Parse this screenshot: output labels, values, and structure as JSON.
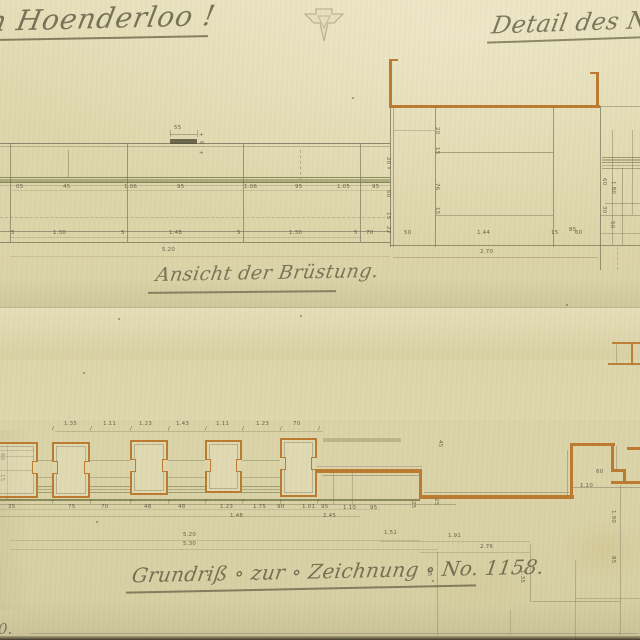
{
  "header": {
    "title_left": "n Hoenderloo !",
    "title_right": "Detail des Nord",
    "stamp_icon": "embossed-triangle-stamp"
  },
  "elevation": {
    "caption": "Ansicht der Brüstung."
  },
  "plan": {
    "caption": "Grundriß ∘ zur ∘ Zeichnung ∘ No. 1158."
  },
  "corner_note": "0.",
  "colors": {
    "p": "#76715a",
    "g": "#6f7340",
    "o": "#bd7b31",
    "d": "#55523c",
    "s": "#a39b76",
    "ink": "#6b684c",
    "paper": "#ded7ac"
  },
  "geometry": {
    "lines": [
      [
        0,
        143,
        390,
        1,
        "p",
        0.8
      ],
      [
        0,
        146,
        390,
        1,
        "p",
        0.4
      ],
      [
        0,
        177,
        390,
        1,
        "g",
        0.75
      ],
      [
        0,
        179,
        390,
        3,
        "g",
        0.45
      ],
      [
        0,
        182,
        390,
        1,
        "g",
        0.8
      ],
      [
        0,
        185,
        390,
        1,
        "p",
        0.3
      ],
      [
        0,
        217,
        390,
        1,
        "p",
        0.35,
        1
      ],
      [
        0,
        231,
        390,
        1,
        "p",
        0.65
      ],
      [
        0,
        242,
        390,
        1,
        "p",
        0.75
      ],
      [
        12,
        190,
        376,
        1,
        "p",
        0.22
      ],
      [
        10,
        237,
        352,
        1,
        "p",
        0.25
      ],
      [
        10,
        256,
        380,
        1,
        "p",
        0.2
      ],
      [
        10,
        143,
        1,
        99,
        "p",
        0.65
      ],
      [
        127,
        143,
        1,
        99,
        "p",
        0.65
      ],
      [
        243,
        143,
        1,
        99,
        "p",
        0.65
      ],
      [
        360,
        143,
        1,
        99,
        "p",
        0.65
      ],
      [
        68,
        150,
        1,
        28,
        "p",
        0.45
      ],
      [
        300,
        150,
        1,
        30,
        "p",
        0.45,
        2
      ],
      [
        170,
        139,
        27,
        5,
        "d",
        0.85
      ],
      [
        170,
        134,
        27,
        1,
        "p",
        0.5
      ],
      [
        170,
        130,
        1,
        7,
        "p",
        0.5
      ],
      [
        197,
        130,
        1,
        7,
        "p",
        0.5
      ],
      [
        389,
        59,
        9,
        2,
        "o",
        1
      ],
      [
        389,
        60,
        3,
        47,
        "o",
        1
      ],
      [
        389,
        105,
        211,
        3,
        "o",
        1
      ],
      [
        596,
        73,
        3,
        33,
        "o",
        1
      ],
      [
        590,
        72,
        9,
        2,
        "o",
        1
      ],
      [
        390,
        107,
        1,
        140,
        "p",
        0.75
      ],
      [
        393,
        107,
        1,
        140,
        "p",
        0.5
      ],
      [
        435,
        107,
        1,
        140,
        "p",
        0.65
      ],
      [
        553,
        107,
        1,
        140,
        "p",
        0.65
      ],
      [
        600,
        106,
        1,
        164,
        "p",
        0.7
      ],
      [
        435,
        152,
        118,
        1,
        "p",
        0.55
      ],
      [
        435,
        215,
        118,
        1,
        "p",
        0.45
      ],
      [
        390,
        245,
        250,
        1,
        "p",
        0.7
      ],
      [
        393,
        257,
        205,
        1,
        "p",
        0.35
      ],
      [
        393,
        130,
        42,
        1,
        "p",
        0.3
      ],
      [
        600,
        106,
        40,
        1,
        "p",
        0.45
      ],
      [
        602,
        157,
        38,
        1,
        "g",
        0.6
      ],
      [
        602,
        159,
        38,
        2,
        "g",
        0.4
      ],
      [
        602,
        162,
        38,
        1,
        "g",
        0.6
      ],
      [
        602,
        165,
        38,
        1,
        "p",
        0.4
      ],
      [
        602,
        168,
        38,
        1,
        "g",
        0.5
      ],
      [
        612,
        130,
        1,
        115,
        "p",
        0.45
      ],
      [
        622,
        168,
        1,
        77,
        "p",
        0.45
      ],
      [
        632,
        130,
        1,
        85,
        "p",
        0.4
      ],
      [
        605,
        203,
        35,
        1,
        "p",
        0.45
      ],
      [
        600,
        215,
        40,
        1,
        "p",
        0.45
      ],
      [
        600,
        233,
        40,
        1,
        "p",
        0.35
      ],
      [
        617,
        247,
        1,
        23,
        "p",
        0.3,
        2
      ],
      [
        0,
        307,
        640,
        1,
        "s",
        0.45
      ],
      [
        55,
        431,
        268,
        1,
        "p",
        0.3
      ],
      [
        0,
        450,
        34,
        1,
        "p",
        0.45
      ],
      [
        0,
        456,
        34,
        1,
        "p",
        0.45
      ],
      [
        0,
        470,
        34,
        1,
        "g",
        0.45
      ],
      [
        38,
        460,
        14,
        1,
        "p",
        0.4
      ],
      [
        90,
        460,
        40,
        1,
        "p",
        0.4
      ],
      [
        168,
        460,
        37,
        1,
        "p",
        0.4
      ],
      [
        242,
        460,
        38,
        1,
        "p",
        0.4
      ],
      [
        38,
        477,
        14,
        1,
        "p",
        0.35
      ],
      [
        90,
        477,
        40,
        1,
        "p",
        0.35
      ],
      [
        168,
        477,
        37,
        1,
        "p",
        0.35
      ],
      [
        242,
        477,
        38,
        1,
        "p",
        0.35
      ],
      [
        38,
        486,
        14,
        1,
        "g",
        0.55
      ],
      [
        38,
        489,
        14,
        1,
        "g",
        0.4
      ],
      [
        38,
        492,
        14,
        1,
        "g",
        0.55
      ],
      [
        90,
        486,
        40,
        1,
        "g",
        0.55
      ],
      [
        90,
        489,
        40,
        1,
        "g",
        0.4
      ],
      [
        90,
        492,
        40,
        1,
        "g",
        0.55
      ],
      [
        168,
        486,
        37,
        1,
        "g",
        0.55
      ],
      [
        168,
        489,
        37,
        1,
        "g",
        0.4
      ],
      [
        168,
        492,
        37,
        1,
        "g",
        0.55
      ],
      [
        242,
        486,
        38,
        1,
        "g",
        0.55
      ],
      [
        242,
        489,
        38,
        1,
        "g",
        0.4
      ],
      [
        242,
        492,
        38,
        1,
        "g",
        0.55
      ],
      [
        323,
        438,
        78,
        4,
        "g",
        0.3
      ],
      [
        317,
        469,
        105,
        3.5,
        "o",
        1
      ],
      [
        317,
        466,
        105,
        1,
        "p",
        0.35
      ],
      [
        322,
        475,
        98,
        1,
        "p",
        0.45
      ],
      [
        419,
        470,
        3,
        28,
        "o",
        1
      ],
      [
        419,
        495,
        155,
        3.5,
        "o",
        1
      ],
      [
        424,
        492,
        145,
        1,
        "p",
        0.45
      ],
      [
        570,
        446,
        3,
        52,
        "o",
        1
      ],
      [
        567,
        450,
        1,
        45,
        "p",
        0.4
      ],
      [
        570,
        443,
        45,
        2.5,
        "o",
        1
      ],
      [
        611,
        443,
        2.5,
        29,
        "o",
        1
      ],
      [
        611,
        469,
        15,
        2.5,
        "o",
        1
      ],
      [
        623,
        469,
        2.5,
        14,
        "o",
        1
      ],
      [
        611,
        481,
        29,
        2.5,
        "o",
        1
      ],
      [
        627,
        447,
        13,
        2.5,
        "o",
        1
      ],
      [
        572,
        487,
        68,
        1,
        "p",
        0.45
      ],
      [
        616,
        446,
        1,
        24,
        "p",
        0.35
      ],
      [
        612,
        342,
        28,
        2,
        "o",
        0.95
      ],
      [
        608,
        363,
        32,
        2,
        "o",
        0.95
      ],
      [
        631,
        342,
        2,
        23,
        "o",
        0.95
      ],
      [
        616,
        344,
        1,
        20,
        "p",
        0.35
      ],
      [
        0,
        499,
        420,
        1.5,
        "g",
        0.75
      ],
      [
        0,
        504,
        456,
        1,
        "p",
        0.45
      ],
      [
        0,
        509,
        380,
        1,
        "p",
        0.22
      ],
      [
        0,
        516,
        360,
        1,
        "p",
        0.3
      ],
      [
        10,
        540,
        410,
        1,
        "p",
        0.25
      ],
      [
        10,
        549,
        428,
        1,
        "p",
        0.25
      ],
      [
        380,
        541,
        150,
        1,
        "p",
        0.28
      ],
      [
        420,
        552,
        110,
        1,
        "p",
        0.28
      ],
      [
        437,
        552,
        1,
        83,
        "p",
        0.4
      ],
      [
        530,
        544,
        1,
        58,
        "p",
        0.4
      ],
      [
        532,
        601,
        88,
        1,
        "p",
        0.4
      ],
      [
        575,
        560,
        1,
        80,
        "p",
        0.35
      ],
      [
        575,
        598,
        65,
        1,
        "p",
        0.35
      ],
      [
        620,
        485,
        1,
        150,
        "p",
        0.4
      ],
      [
        30,
        633,
        608,
        1,
        "p",
        0.35
      ],
      [
        510,
        610,
        1,
        25,
        "p",
        0.3
      ],
      [
        7,
        445,
        1,
        55,
        "p",
        0.35
      ],
      [
        333,
        473,
        1,
        32,
        "p",
        0.4
      ],
      [
        352,
        473,
        1,
        32,
        "p",
        0.35
      ]
    ],
    "labels": [
      [
        16,
        185,
        "05"
      ],
      [
        63,
        185,
        "45"
      ],
      [
        124,
        185,
        "1.06"
      ],
      [
        177,
        185,
        "95"
      ],
      [
        244,
        185,
        "1.06"
      ],
      [
        295,
        185,
        "95"
      ],
      [
        337,
        185,
        "1.05"
      ],
      [
        372,
        185,
        "95"
      ],
      [
        11,
        231,
        "5"
      ],
      [
        53,
        231,
        "1.30"
      ],
      [
        121,
        231,
        "5"
      ],
      [
        169,
        231,
        "1.48"
      ],
      [
        237,
        231,
        "5"
      ],
      [
        289,
        231,
        "1.30"
      ],
      [
        354,
        231,
        "5"
      ],
      [
        366,
        231,
        "70"
      ],
      [
        174,
        126,
        "55"
      ],
      [
        199,
        133,
        "+"
      ],
      [
        199,
        151,
        "+"
      ],
      [
        203,
        141,
        "6",
        90
      ],
      [
        162,
        248,
        "5.20"
      ],
      [
        404,
        231,
        "50"
      ],
      [
        477,
        231,
        "1.44"
      ],
      [
        551,
        231,
        "15"
      ],
      [
        575,
        231,
        "60"
      ],
      [
        480,
        250,
        "2.70"
      ],
      [
        390,
        157,
        "20",
        90
      ],
      [
        390,
        190,
        "60",
        90
      ],
      [
        390,
        212,
        "15",
        90
      ],
      [
        390,
        226,
        "22",
        90
      ],
      [
        439,
        127,
        "20",
        90
      ],
      [
        439,
        147,
        "15",
        90
      ],
      [
        439,
        183,
        "76",
        90
      ],
      [
        439,
        207,
        "15",
        90
      ],
      [
        569,
        228,
        "85"
      ],
      [
        606,
        178,
        "60",
        90
      ],
      [
        615,
        181,
        "1.80",
        90
      ],
      [
        606,
        206,
        "30",
        90
      ],
      [
        614,
        221,
        "50",
        90
      ],
      [
        64,
        422,
        "1.35"
      ],
      [
        103,
        422,
        "1.11"
      ],
      [
        139,
        422,
        "1.23"
      ],
      [
        176,
        422,
        "1.43"
      ],
      [
        216,
        422,
        "1.11"
      ],
      [
        256,
        422,
        "1.23"
      ],
      [
        293,
        422,
        "70"
      ],
      [
        52,
        427,
        "∕"
      ],
      [
        90,
        427,
        "∕"
      ],
      [
        130,
        427,
        "∕"
      ],
      [
        168,
        427,
        "∕"
      ],
      [
        205,
        427,
        "∕"
      ],
      [
        242,
        427,
        "∕"
      ],
      [
        280,
        427,
        "∕"
      ],
      [
        318,
        427,
        "∕"
      ],
      [
        8,
        505,
        "35"
      ],
      [
        68,
        505,
        "75"
      ],
      [
        101,
        505,
        "70"
      ],
      [
        144,
        505,
        "48"
      ],
      [
        178,
        505,
        "48"
      ],
      [
        220,
        505,
        "1.23"
      ],
      [
        253,
        505,
        "1.75"
      ],
      [
        277,
        505,
        "90"
      ],
      [
        302,
        505,
        "1.01"
      ],
      [
        321,
        505,
        "95"
      ],
      [
        343,
        506,
        "1.10"
      ],
      [
        370,
        506,
        "95"
      ],
      [
        52,
        500,
        "∕"
      ],
      [
        90,
        500,
        "∕"
      ],
      [
        130,
        500,
        "∕"
      ],
      [
        168,
        500,
        "∕"
      ],
      [
        205,
        500,
        "∕"
      ],
      [
        242,
        500,
        "∕"
      ],
      [
        280,
        500,
        "∕"
      ],
      [
        317,
        500,
        "∕"
      ],
      [
        230,
        514,
        "1.48"
      ],
      [
        323,
        514,
        "2.45"
      ],
      [
        183,
        533,
        "5.20"
      ],
      [
        183,
        542,
        "5.30"
      ],
      [
        384,
        531,
        "1.51"
      ],
      [
        448,
        534,
        "1.91"
      ],
      [
        480,
        545,
        "2.76"
      ],
      [
        415,
        501,
        "25",
        90
      ],
      [
        438,
        498,
        "25",
        90
      ],
      [
        442,
        440,
        "45",
        90
      ],
      [
        4,
        453,
        "60",
        90
      ],
      [
        4,
        474,
        "15",
        90
      ],
      [
        596,
        470,
        "60"
      ],
      [
        580,
        484,
        "1.10"
      ],
      [
        615,
        510,
        "1.90",
        90
      ],
      [
        615,
        556,
        "85",
        90
      ],
      [
        524,
        570,
        "1.35",
        90
      ],
      [
        431,
        569,
        "45",
        90
      ]
    ],
    "pillars": [
      [
        -8,
        442,
        46,
        56
      ],
      [
        52,
        442,
        38,
        56
      ],
      [
        130,
        440,
        38,
        55
      ],
      [
        205,
        440,
        37,
        53
      ],
      [
        280,
        438,
        37,
        59
      ]
    ],
    "specks": [
      [
        83,
        372
      ],
      [
        352,
        97
      ],
      [
        207,
        574
      ],
      [
        432,
        580
      ],
      [
        118,
        318
      ],
      [
        566,
        304
      ],
      [
        96,
        521
      ],
      [
        388,
        167
      ],
      [
        300,
        315
      ]
    ]
  }
}
